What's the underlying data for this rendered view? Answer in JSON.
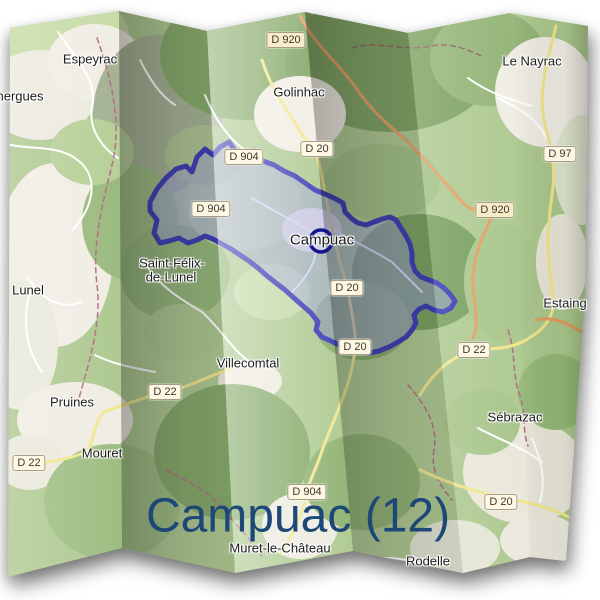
{
  "page": {
    "background": "#ffffff"
  },
  "title": {
    "text": "Campuac (12)",
    "color": "#1d4777",
    "x": 298,
    "y": 516,
    "size": 48
  },
  "marker": {
    "x": 321,
    "y": 241,
    "r": 11,
    "color": "#15158a",
    "stroke_width": 3.5
  },
  "commune": {
    "name": "Campuac",
    "fill": "rgba(150,150,228,0.45)",
    "border": "#2e2eb0",
    "border_width": 5,
    "points": [
      [
        150,
        202
      ],
      [
        157,
        189
      ],
      [
        166,
        178
      ],
      [
        176,
        169
      ],
      [
        186,
        166
      ],
      [
        192,
        172
      ],
      [
        197,
        157
      ],
      [
        205,
        149
      ],
      [
        213,
        155
      ],
      [
        220,
        147
      ],
      [
        229,
        142
      ],
      [
        236,
        152
      ],
      [
        246,
        157
      ],
      [
        254,
        151
      ],
      [
        263,
        161
      ],
      [
        274,
        165
      ],
      [
        284,
        171
      ],
      [
        295,
        176
      ],
      [
        305,
        183
      ],
      [
        315,
        190
      ],
      [
        325,
        194
      ],
      [
        336,
        199
      ],
      [
        343,
        203
      ],
      [
        345,
        212
      ],
      [
        352,
        219
      ],
      [
        358,
        223
      ],
      [
        366,
        225
      ],
      [
        374,
        222
      ],
      [
        382,
        219
      ],
      [
        390,
        217
      ],
      [
        396,
        220
      ],
      [
        401,
        228
      ],
      [
        406,
        236
      ],
      [
        410,
        244
      ],
      [
        412,
        253
      ],
      [
        412,
        262
      ],
      [
        415,
        271
      ],
      [
        421,
        277
      ],
      [
        429,
        280
      ],
      [
        437,
        283
      ],
      [
        444,
        288
      ],
      [
        450,
        294
      ],
      [
        455,
        301
      ],
      [
        451,
        308
      ],
      [
        443,
        312
      ],
      [
        434,
        310
      ],
      [
        426,
        306
      ],
      [
        419,
        309
      ],
      [
        414,
        315
      ],
      [
        416,
        323
      ],
      [
        412,
        330
      ],
      [
        406,
        337
      ],
      [
        398,
        342
      ],
      [
        389,
        347
      ],
      [
        379,
        351
      ],
      [
        369,
        353
      ],
      [
        359,
        352
      ],
      [
        350,
        349
      ],
      [
        341,
        346
      ],
      [
        331,
        341
      ],
      [
        322,
        337
      ],
      [
        316,
        330
      ],
      [
        318,
        322
      ],
      [
        311,
        313
      ],
      [
        303,
        306
      ],
      [
        294,
        298
      ],
      [
        285,
        290
      ],
      [
        276,
        283
      ],
      [
        267,
        276
      ],
      [
        258,
        268
      ],
      [
        249,
        261
      ],
      [
        240,
        255
      ],
      [
        231,
        249
      ],
      [
        222,
        244
      ],
      [
        213,
        239
      ],
      [
        205,
        236
      ],
      [
        197,
        240
      ],
      [
        188,
        243
      ],
      [
        179,
        238
      ],
      [
        169,
        241
      ],
      [
        160,
        243
      ],
      [
        154,
        233
      ],
      [
        157,
        220
      ],
      [
        150,
        211
      ]
    ]
  },
  "map": {
    "base_color": "#a9c68a",
    "outline": [
      [
        10,
        28
      ],
      [
        119,
        11
      ],
      [
        207,
        31
      ],
      [
        305,
        12
      ],
      [
        408,
        33
      ],
      [
        510,
        13
      ],
      [
        588,
        26
      ],
      [
        585,
        295
      ],
      [
        566,
        561
      ],
      [
        530,
        557
      ],
      [
        463,
        573
      ],
      [
        353,
        551
      ],
      [
        235,
        573
      ],
      [
        122,
        548
      ],
      [
        8,
        577
      ]
    ],
    "panels": [
      {
        "pts": [
          [
            10,
            28
          ],
          [
            119,
            11
          ],
          [
            122,
            548
          ],
          [
            8,
            577
          ]
        ],
        "shade": "fold-light"
      },
      {
        "pts": [
          [
            119,
            11
          ],
          [
            207,
            31
          ],
          [
            235,
            573
          ],
          [
            122,
            548
          ]
        ],
        "shade": "fold-dark"
      },
      {
        "pts": [
          [
            207,
            31
          ],
          [
            305,
            12
          ],
          [
            353,
            551
          ],
          [
            235,
            573
          ]
        ],
        "shade": "fold-bright"
      },
      {
        "pts": [
          [
            305,
            12
          ],
          [
            408,
            33
          ],
          [
            463,
            573
          ],
          [
            353,
            551
          ]
        ],
        "shade": "fold-dark"
      },
      {
        "pts": [
          [
            408,
            33
          ],
          [
            510,
            13
          ],
          [
            530,
            557
          ],
          [
            463,
            573
          ]
        ],
        "shade": "fold-light"
      },
      {
        "pts": [
          [
            510,
            13
          ],
          [
            588,
            26
          ],
          [
            585,
            295
          ],
          [
            566,
            561
          ],
          [
            530,
            557
          ]
        ],
        "shade": "fold-edge"
      }
    ],
    "blobs": [
      [
        60,
        40,
        70,
        50,
        "#c4d9a2"
      ],
      [
        40,
        95,
        55,
        45,
        "#ece9dd"
      ],
      [
        95,
        62,
        48,
        38,
        "#efece2"
      ],
      [
        158,
        115,
        65,
        80,
        "#9fae8c"
      ],
      [
        245,
        55,
        85,
        65,
        "#7ea45f"
      ],
      [
        390,
        62,
        105,
        70,
        "#759c57"
      ],
      [
        300,
        114,
        46,
        38,
        "#efece1"
      ],
      [
        488,
        58,
        58,
        48,
        "#8db06f"
      ],
      [
        545,
        92,
        50,
        55,
        "#efece2"
      ],
      [
        582,
        170,
        28,
        55,
        "#dce3ca"
      ],
      [
        55,
        255,
        58,
        92,
        "#efece3"
      ],
      [
        20,
        345,
        38,
        65,
        "#e8e7d8"
      ],
      [
        130,
        222,
        48,
        58,
        "#95b678"
      ],
      [
        175,
        273,
        55,
        48,
        "#8db171"
      ],
      [
        243,
        203,
        58,
        48,
        "#b7d098"
      ],
      [
        205,
        155,
        40,
        30,
        "#a9c18b"
      ],
      [
        312,
        230,
        30,
        22,
        "#ece9dd"
      ],
      [
        382,
        182,
        58,
        38,
        "#9cbd7e"
      ],
      [
        420,
        272,
        68,
        58,
        "#6f9a54"
      ],
      [
        362,
        322,
        48,
        38,
        "#82a763"
      ],
      [
        502,
        282,
        38,
        58,
        "#a5c386"
      ],
      [
        562,
        262,
        26,
        48,
        "#e7e5d6"
      ],
      [
        75,
        420,
        58,
        38,
        "#eeebe0"
      ],
      [
        30,
        462,
        34,
        28,
        "#e9e7d8"
      ],
      [
        112,
        502,
        68,
        58,
        "#98ba7a"
      ],
      [
        250,
        381,
        32,
        20,
        "#ece9dd"
      ],
      [
        232,
        452,
        78,
        68,
        "#7da45e"
      ],
      [
        300,
        526,
        38,
        33,
        "#eceadd"
      ],
      [
        362,
        482,
        58,
        48,
        "#89ae6a"
      ],
      [
        525,
        472,
        62,
        52,
        "#e9e6d8"
      ],
      [
        455,
        548,
        45,
        28,
        "#e2e4d2"
      ],
      [
        556,
        392,
        38,
        38,
        "#92b675"
      ],
      [
        482,
        422,
        38,
        33,
        "#a3c284"
      ],
      [
        182,
        332,
        38,
        28,
        "#a6c387"
      ],
      [
        92,
        152,
        42,
        33,
        "#b2cd92"
      ],
      [
        272,
        292,
        38,
        28,
        "#c0d6a0"
      ],
      [
        540,
        540,
        40,
        26,
        "#eae8db"
      ]
    ],
    "roads": [
      {
        "d": "M58,32 C78,62 98,80 92,108 C88,128 102,148 118,158",
        "c": "#ffffff",
        "w": 2
      },
      {
        "d": "M0,142 C28,152 58,142 80,162 C100,180 92,210 72,230",
        "c": "#ffffff",
        "w": 2
      },
      {
        "d": "M28,278 C42,300 62,310 82,302",
        "c": "#ffffff",
        "w": 2
      },
      {
        "d": "M30,292 C22,320 26,350 42,372",
        "c": "#ffffff",
        "w": 2
      },
      {
        "d": "M148,268 C162,288 182,300 202,312 C222,330 232,350 250,362",
        "c": "#ffffff",
        "w": 2
      },
      {
        "d": "M252,198 C272,210 292,220 312,232 C322,252 312,272 292,292",
        "c": "#ffffff",
        "w": 2
      },
      {
        "d": "M330,228 C352,240 372,250 392,262 C402,272 412,282 422,292",
        "c": "#ffffff",
        "w": 2
      },
      {
        "d": "M498,98 C518,108 538,118 546,138",
        "c": "#ffffff",
        "w": 2
      },
      {
        "d": "M468,78 C490,94 512,100 532,106",
        "c": "#ffffff",
        "w": 2
      },
      {
        "d": "M532,438 C542,462 546,482 540,502",
        "c": "#ffffff",
        "w": 2
      },
      {
        "d": "M478,428 C500,440 520,446 542,462",
        "c": "#ffffff",
        "w": 2
      },
      {
        "d": "M95,355 C115,365 135,368 155,372",
        "c": "#ffffff",
        "w": 2
      },
      {
        "d": "M205,95 C215,120 230,140 245,150",
        "c": "#ffffff",
        "w": 2
      },
      {
        "d": "M360,560 C380,556 400,558 418,562",
        "c": "#ffffff",
        "w": 2
      },
      {
        "d": "M140,60 C150,80 160,95 175,105",
        "c": "#ffffff",
        "w": 2
      },
      {
        "d": "M97,38 C112,80 122,124 112,165 C102,205 92,245 97,285 C102,325 88,365 78,402",
        "c": "#b2617f",
        "w": 1.5,
        "dash": "5,4"
      },
      {
        "d": "M352,48 C378,40 402,52 432,46 C452,42 468,50 484,57",
        "c": "#8a5a52",
        "w": 1.5,
        "dash": "5,4"
      },
      {
        "d": "M408,385 C428,408 438,428 434,450 C430,472 442,488 452,500",
        "c": "#b2617f",
        "w": 1.5,
        "dash": "5,4"
      },
      {
        "d": "M166,470 C186,480 210,492 224,510 C238,528 252,540 262,556",
        "c": "#b2617f",
        "w": 1.5,
        "dash": "5,4"
      },
      {
        "d": "M508,330 C516,352 512,376 520,396 C526,412 522,430 528,446",
        "c": "#b2617f",
        "w": 1.5,
        "dash": "5,4"
      },
      {
        "d": "M556,26 C545,70 538,95 545,125 C552,150 556,170 552,195 C546,235 548,265 553,295 C556,315 545,330 524,341 C505,351 488,347 470,352 C448,358 432,375 420,395",
        "c": "#f1e588",
        "w": 3
      },
      {
        "d": "M262,60 C272,92 288,110 298,128 C306,142 312,146 316,150 C322,170 330,225 340,262 C344,276 346,282 348,290 C352,315 356,332 355,345 C354,380 335,415 323,448 C316,470 310,478 307,492 C302,518 290,538 281,553",
        "c": "#f1e588",
        "w": 3
      },
      {
        "d": "M232,368 C205,378 186,388 166,392 C142,398 120,406 104,412 C92,424 96,440 86,452 C62,462 42,462 22,466",
        "c": "#f1e588",
        "w": 3
      },
      {
        "d": "M420,470 C450,484 480,494 516,500 C546,506 566,514 584,526",
        "c": "#f1e588",
        "w": 3
      },
      {
        "d": "M300,16 C315,45 340,65 356,88 C372,112 392,128 408,142 C424,158 446,184 462,202 C478,218 490,206 494,212 C482,238 472,258 473,284 C474,306 480,322 473,338",
        "c": "#e2995a",
        "w": 3
      },
      {
        "d": "M536,320 C550,316 566,322 582,332",
        "c": "#e2995a",
        "w": 3
      }
    ]
  },
  "labels": [
    {
      "text": "nergues",
      "x": 20,
      "y": 96,
      "size": 13
    },
    {
      "text": "Espeyrac",
      "x": 90,
      "y": 59,
      "size": 13
    },
    {
      "text": "Golinhac",
      "x": 299,
      "y": 92,
      "size": 13
    },
    {
      "text": "Le Nayrac",
      "x": 532,
      "y": 61,
      "size": 13
    },
    {
      "text": "Lunel",
      "x": 28,
      "y": 290,
      "size": 13
    },
    {
      "text": "Saint-Félix-",
      "x": 172,
      "y": 263,
      "size": 13
    },
    {
      "text": "de-Lunel",
      "x": 171,
      "y": 277,
      "size": 13
    },
    {
      "text": "Campuac",
      "x": 322,
      "y": 240,
      "size": 15
    },
    {
      "text": "Villecomtal",
      "x": 248,
      "y": 363,
      "size": 13
    },
    {
      "text": "Pruines",
      "x": 72,
      "y": 402,
      "size": 13
    },
    {
      "text": "Mouret",
      "x": 102,
      "y": 453,
      "size": 13
    },
    {
      "text": "Estaing",
      "x": 565,
      "y": 303,
      "size": 13
    },
    {
      "text": "Sébrazac",
      "x": 515,
      "y": 417,
      "size": 13
    },
    {
      "text": "Muret-le-Château",
      "x": 280,
      "y": 548,
      "size": 13
    },
    {
      "text": "Rodelle",
      "x": 428,
      "y": 561,
      "size": 13
    }
  ],
  "badges": [
    {
      "text": "D 920",
      "x": 286,
      "y": 40,
      "bg": "#f9ecc9"
    },
    {
      "text": "D 20",
      "x": 317,
      "y": 149
    },
    {
      "text": "D 904",
      "x": 244,
      "y": 157
    },
    {
      "text": "D 904",
      "x": 211,
      "y": 209
    },
    {
      "text": "D 20",
      "x": 347,
      "y": 288
    },
    {
      "text": "D 20",
      "x": 355,
      "y": 347
    },
    {
      "text": "D 920",
      "x": 495,
      "y": 210,
      "bg": "#f9ecc9"
    },
    {
      "text": "D 97",
      "x": 560,
      "y": 154
    },
    {
      "text": "D 22",
      "x": 474,
      "y": 350
    },
    {
      "text": "D 22",
      "x": 165,
      "y": 392
    },
    {
      "text": "D 22",
      "x": 29,
      "y": 463
    },
    {
      "text": "D 904",
      "x": 307,
      "y": 492
    },
    {
      "text": "D 20",
      "x": 501,
      "y": 502
    }
  ]
}
